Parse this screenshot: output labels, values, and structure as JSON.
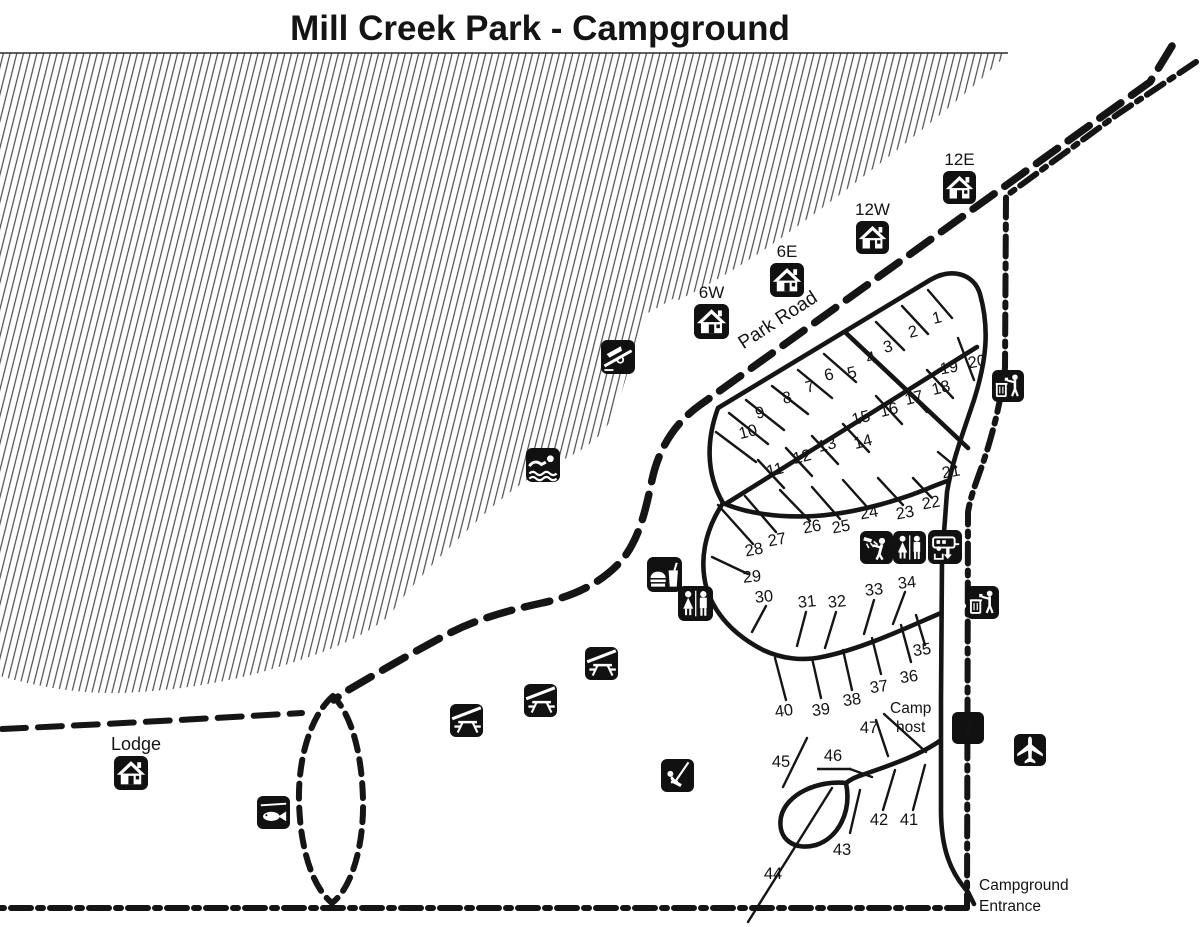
{
  "title": "Mill Creek Park - Campground",
  "labels": {
    "park_road": "Park Road",
    "lodge": "Lodge",
    "camp_host_line1": "Camp",
    "camp_host_line2": "host",
    "entrance_line1": "Campground",
    "entrance_line2": "Entrance"
  },
  "colors": {
    "ink": "#151515",
    "background": "#ffffff"
  },
  "cabins": [
    {
      "label": "6W",
      "x": 694,
      "y": 304,
      "s": 35
    },
    {
      "label": "6E",
      "x": 770,
      "y": 263,
      "s": 34
    },
    {
      "label": "12W",
      "x": 856,
      "y": 221,
      "s": 33
    },
    {
      "label": "12E",
      "x": 943,
      "y": 171,
      "s": 33
    },
    {
      "label": "Lodge",
      "x": 114,
      "y": 756,
      "s": 34,
      "name": "lodge"
    }
  ],
  "sites": [
    {
      "n": "1",
      "x": 937,
      "y": 318,
      "r": -14
    },
    {
      "n": "2",
      "x": 913,
      "y": 332,
      "r": -14
    },
    {
      "n": "3",
      "x": 888,
      "y": 347,
      "r": -14
    },
    {
      "n": "4",
      "x": 871,
      "y": 358,
      "r": -14
    },
    {
      "n": "5",
      "x": 852,
      "y": 373,
      "r": -14
    },
    {
      "n": "6",
      "x": 829,
      "y": 375,
      "r": -14
    },
    {
      "n": "7",
      "x": 810,
      "y": 387,
      "r": -14
    },
    {
      "n": "8",
      "x": 787,
      "y": 398,
      "r": -14
    },
    {
      "n": "9",
      "x": 760,
      "y": 413,
      "r": -14
    },
    {
      "n": "10",
      "x": 748,
      "y": 432,
      "r": -14
    },
    {
      "n": "11",
      "x": 775,
      "y": 470,
      "r": -14
    },
    {
      "n": "12",
      "x": 802,
      "y": 457,
      "r": -14
    },
    {
      "n": "13",
      "x": 827,
      "y": 445,
      "r": -14
    },
    {
      "n": "14",
      "x": 863,
      "y": 442,
      "r": -14
    },
    {
      "n": "15",
      "x": 861,
      "y": 418,
      "r": -14
    },
    {
      "n": "16",
      "x": 889,
      "y": 410,
      "r": -14
    },
    {
      "n": "17",
      "x": 914,
      "y": 398,
      "r": -14
    },
    {
      "n": "18",
      "x": 941,
      "y": 388,
      "r": -14
    },
    {
      "n": "19",
      "x": 949,
      "y": 368,
      "r": -10
    },
    {
      "n": "20",
      "x": 977,
      "y": 362,
      "r": -10
    },
    {
      "n": "21",
      "x": 951,
      "y": 472,
      "r": -10
    },
    {
      "n": "22",
      "x": 931,
      "y": 503,
      "r": -10
    },
    {
      "n": "23",
      "x": 905,
      "y": 513,
      "r": -10
    },
    {
      "n": "24",
      "x": 869,
      "y": 513,
      "r": -10
    },
    {
      "n": "25",
      "x": 841,
      "y": 527,
      "r": -10
    },
    {
      "n": "26",
      "x": 812,
      "y": 527,
      "r": -10
    },
    {
      "n": "27",
      "x": 777,
      "y": 540,
      "r": -10
    },
    {
      "n": "28",
      "x": 754,
      "y": 550,
      "r": -10
    },
    {
      "n": "29",
      "x": 752,
      "y": 577,
      "r": -6
    },
    {
      "n": "30",
      "x": 764,
      "y": 597,
      "r": -6
    },
    {
      "n": "31",
      "x": 807,
      "y": 602,
      "r": -6
    },
    {
      "n": "32",
      "x": 837,
      "y": 602,
      "r": -6
    },
    {
      "n": "33",
      "x": 874,
      "y": 590,
      "r": -6
    },
    {
      "n": "34",
      "x": 907,
      "y": 583,
      "r": -6
    },
    {
      "n": "35",
      "x": 922,
      "y": 650,
      "r": -8
    },
    {
      "n": "36",
      "x": 909,
      "y": 677,
      "r": -8
    },
    {
      "n": "37",
      "x": 879,
      "y": 687,
      "r": -8
    },
    {
      "n": "38",
      "x": 852,
      "y": 700,
      "r": -8
    },
    {
      "n": "39",
      "x": 821,
      "y": 710,
      "r": -8
    },
    {
      "n": "40",
      "x": 784,
      "y": 711,
      "r": -8
    },
    {
      "n": "41",
      "x": 909,
      "y": 820,
      "r": 0
    },
    {
      "n": "42",
      "x": 879,
      "y": 820,
      "r": 0
    },
    {
      "n": "43",
      "x": 842,
      "y": 850,
      "r": 0
    },
    {
      "n": "44",
      "x": 773,
      "y": 874,
      "r": 0
    },
    {
      "n": "45",
      "x": 781,
      "y": 762,
      "r": 0
    },
    {
      "n": "46",
      "x": 833,
      "y": 756,
      "r": 0,
      "underline": true
    },
    {
      "n": "47",
      "x": 869,
      "y": 728,
      "r": 0
    }
  ],
  "amenities": [
    {
      "type": "boat-ramp",
      "name": "boat-ramp-icon",
      "x": 601,
      "y": 340,
      "s": 34
    },
    {
      "type": "swimming",
      "name": "swimming-icon",
      "x": 526,
      "y": 448,
      "s": 34
    },
    {
      "type": "food",
      "name": "concessions-icon",
      "x": 647,
      "y": 557,
      "s": 35
    },
    {
      "type": "restroom",
      "name": "restroom-icon",
      "x": 678,
      "y": 586,
      "s": 35
    },
    {
      "type": "shower",
      "name": "shower-icon",
      "x": 860,
      "y": 531,
      "s": 33
    },
    {
      "type": "restroom",
      "name": "restroom-icon",
      "x": 893,
      "y": 531,
      "s": 33
    },
    {
      "type": "rv-dump",
      "name": "rv-dump-station-icon",
      "x": 928,
      "y": 530,
      "s": 34
    },
    {
      "type": "trash",
      "name": "trash-icon",
      "x": 992,
      "y": 370,
      "s": 32
    },
    {
      "type": "trash",
      "name": "trash-icon",
      "x": 966,
      "y": 586,
      "s": 33
    },
    {
      "type": "picnic-shelter",
      "name": "picnic-shelter-icon",
      "x": 585,
      "y": 647,
      "s": 33
    },
    {
      "type": "picnic-shelter",
      "name": "picnic-shelter-icon",
      "x": 524,
      "y": 684,
      "s": 33
    },
    {
      "type": "picnic-shelter",
      "name": "picnic-shelter-icon",
      "x": 450,
      "y": 704,
      "s": 33
    },
    {
      "type": "playground",
      "name": "playground-icon",
      "x": 661,
      "y": 759,
      "s": 33
    },
    {
      "type": "info",
      "name": "information-icon",
      "x": 952,
      "y": 712,
      "s": 32
    },
    {
      "type": "airplane",
      "name": "airport-icon",
      "x": 1014,
      "y": 734,
      "s": 32
    },
    {
      "type": "fish",
      "name": "fishing-icon",
      "x": 257,
      "y": 796,
      "s": 33
    }
  ]
}
